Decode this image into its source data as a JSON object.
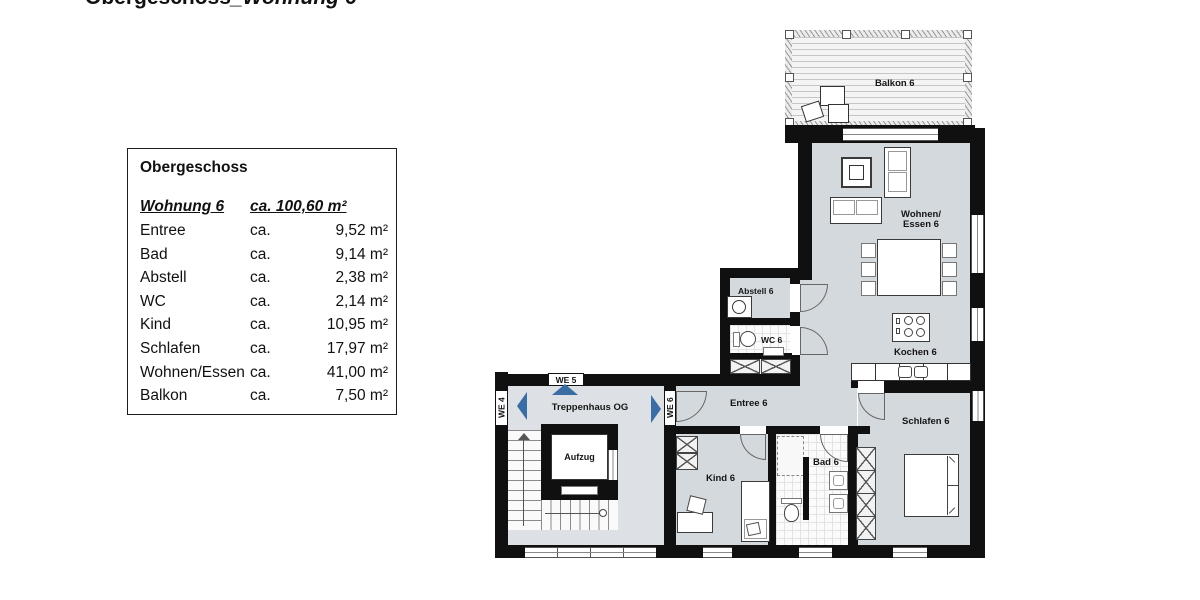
{
  "header": {
    "title_main": "Obergeschoss",
    "title_suffix": "_Wohnung 6"
  },
  "legend": {
    "title": "Obergeschoss",
    "unit": {
      "name": "Wohnung 6",
      "area": "ca. 100,60 m²"
    },
    "rows": [
      {
        "name": "Entree",
        "ca": "ca.",
        "area": "9,52 m²"
      },
      {
        "name": "Bad",
        "ca": "ca.",
        "area": "9,14 m²"
      },
      {
        "name": "Abstell",
        "ca": "ca.",
        "area": "2,38 m²"
      },
      {
        "name": "WC",
        "ca": "ca.",
        "area": "2,14 m²"
      },
      {
        "name": "Kind",
        "ca": "ca.",
        "area": "10,95 m²"
      },
      {
        "name": "Schlafen",
        "ca": "ca.",
        "area": "17,97 m²"
      },
      {
        "name": "Wohnen/Essen",
        "ca": "ca.",
        "area": "41,00 m²"
      },
      {
        "name": "Balkon",
        "ca": "ca.",
        "area": "7,50 m²"
      }
    ]
  },
  "plan": {
    "labels": {
      "balkon": "Balkon 6",
      "wohnen_line1": "Wohnen/",
      "wohnen_line2": "Essen 6",
      "kochen": "Kochen 6",
      "abstell": "Abstell 6",
      "wc": "WC 6",
      "entree": "Entree 6",
      "treppenhaus": "Treppenhaus OG",
      "aufzug": "Aufzug",
      "kind": "Kind 6",
      "bad": "Bad 6",
      "schlafen": "Schlafen 6",
      "we4": "WE 4",
      "we5": "WE 5",
      "we6": "WE 6"
    },
    "colors": {
      "wall": "#101010",
      "floor": "#d4d9de",
      "arrow": "#3a6da3"
    }
  }
}
